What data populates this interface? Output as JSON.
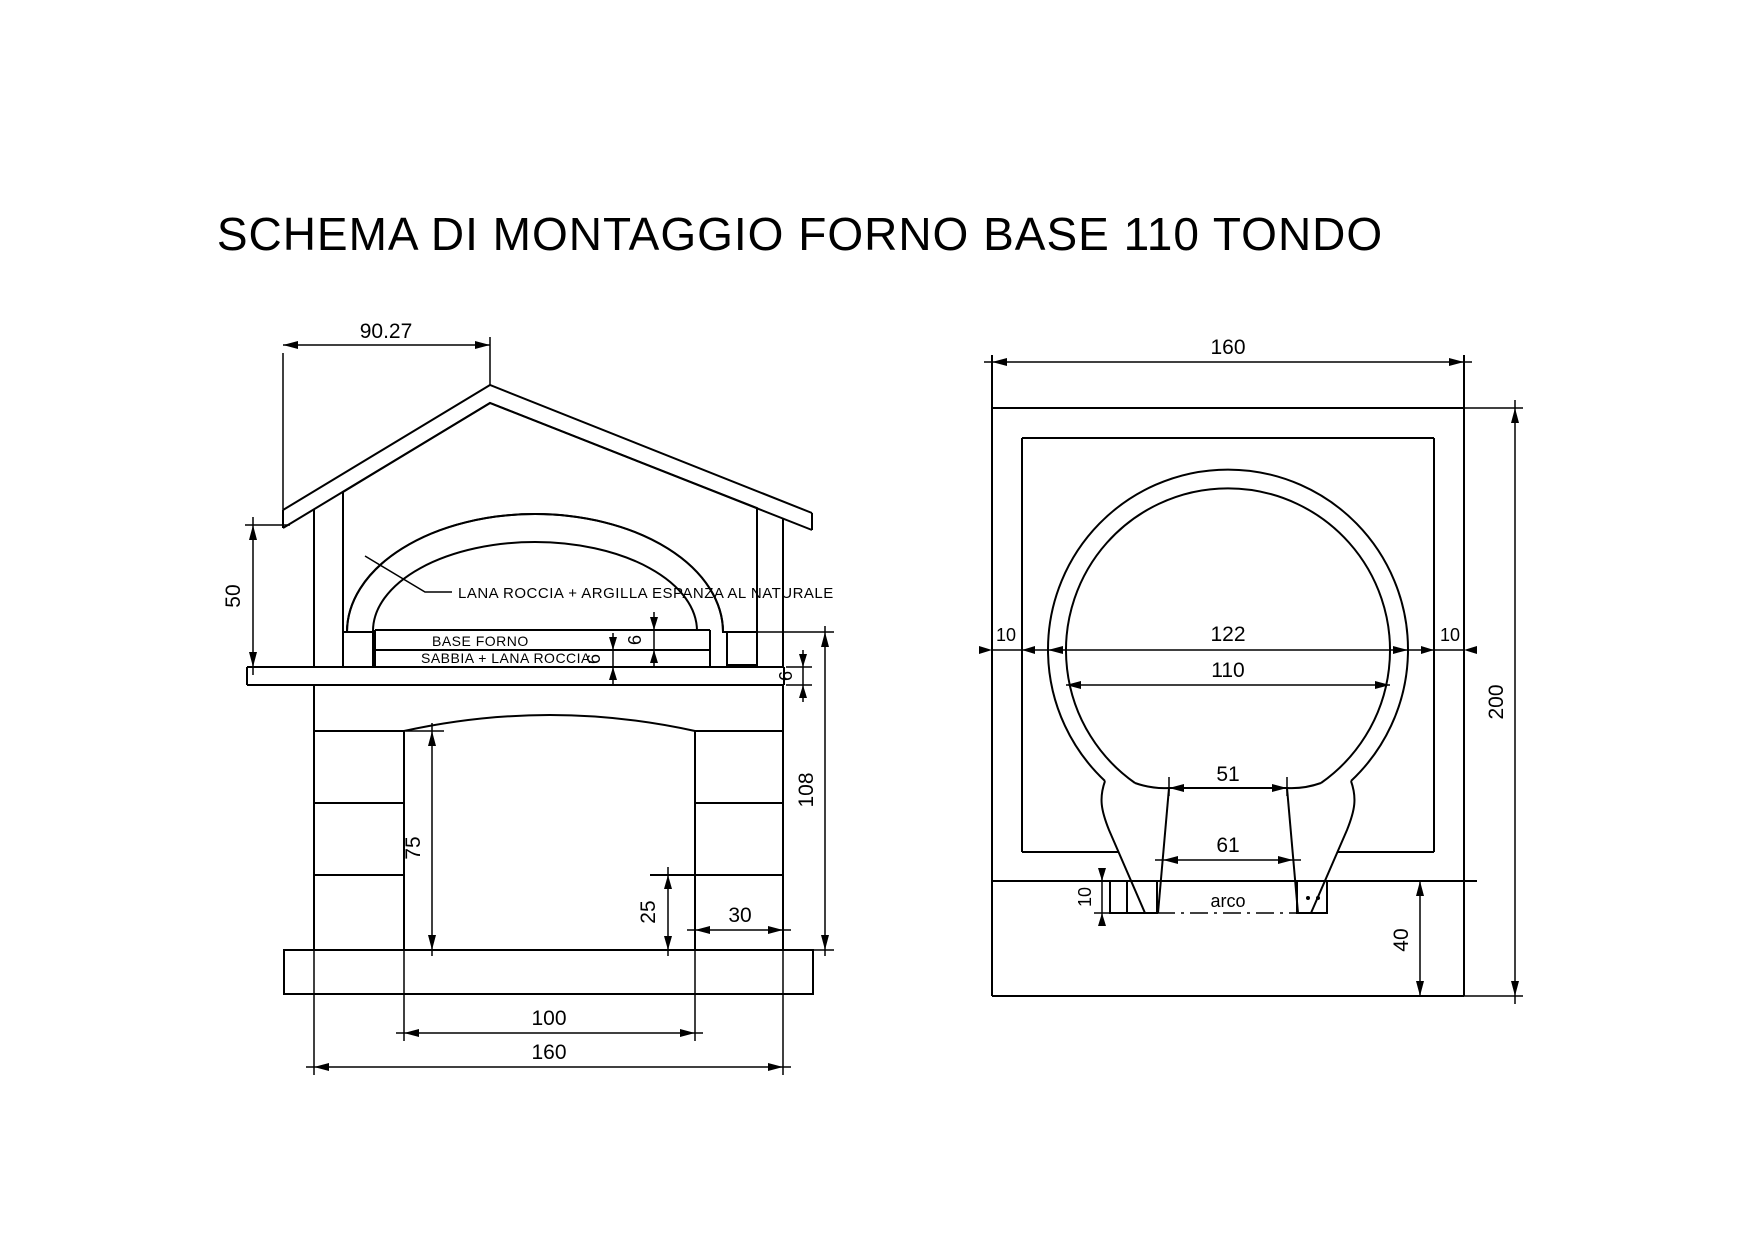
{
  "title": "SCHEMA DI MONTAGGIO FORNO BASE 110 TONDO",
  "front_view": {
    "annotations": {
      "insulation_label": "LANA ROCCIA + ARGILLA ESPANZA AL  NATURALE",
      "oven_base_label": "BASE FORNO",
      "sand_label": "SABBIA + LANA ROCCIA"
    },
    "dimensions": {
      "roof_left_span": "90.27",
      "gable_height": "50",
      "oven_floor_thickness": "6",
      "sand_layer_thickness": "6",
      "counter_slab_thickness": "6",
      "stand_height": "108",
      "opening_height": "75",
      "ledge_height": "25",
      "pier_width": "30",
      "opening_width": "100",
      "total_width": "160"
    }
  },
  "plan_view": {
    "annotations": {
      "arch_label": "arco"
    },
    "dimensions": {
      "total_width": "160",
      "total_depth": "200",
      "left_wall_offset": "10",
      "dome_outer_diameter": "122",
      "dome_inner_diameter": "110",
      "right_wall_offset": "10",
      "mouth_inner_width": "51",
      "mouth_outer_width": "61",
      "arch_thickness": "10",
      "front_apron_depth": "40"
    }
  },
  "colors": {
    "line": "#000000",
    "background": "#ffffff"
  }
}
